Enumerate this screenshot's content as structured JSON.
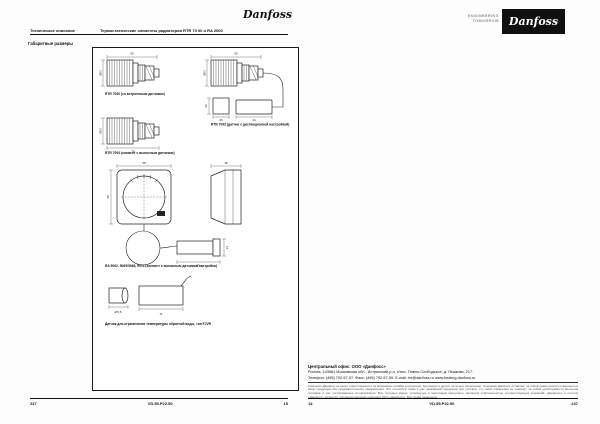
{
  "left_page": {
    "header": {
      "doc_type": "Техническое описание",
      "title": "Термостатические элементы радиаторов RTR 70 00 и RA 2000"
    },
    "logo_text": "Danfoss",
    "section_label": "Габаритные размеры",
    "figures": {
      "fig1_caption": "RTR 7090 (со встроенным датчиком)",
      "fig2_caption": "RTR 7092 (датчик с дистанционной настройкой)",
      "fig3_caption": "RTR 7094 (элемент с выносным датчиком)",
      "fig4_caption": "RA 5062, 5065/5068, 5074 (элемент с выносным датчиком настройки)",
      "fig5_caption": "Датчик для ограничения температуры обратной воды, тип FJVR",
      "dims": {
        "d80": "80",
        "d53": "Ø53",
        "d74": "74",
        "d28": "28",
        "d26": "26",
        "d44": "44",
        "d58": "58",
        "d48": "48",
        "d63": "63",
        "d21": "21",
        "d71": "71",
        "d55": "Ø 5,5"
      }
    },
    "footer": {
      "page_left": "247",
      "doc_code": "VD.55.P22.50",
      "page_right": "15"
    }
  },
  "right_page": {
    "brand": {
      "tagline_line1": "ENGINEERING",
      "tagline_line2": "TOMORROW",
      "logo_text": "Danfoss"
    },
    "office": {
      "line1": "Центральный офис: ООО «Данфосс»",
      "line2": "Россия, 143581 Московская обл., Истринский р-н, с/пос. Павло-Слободское, д. Лешково, 217.",
      "line3": "Телефон: (495) 792-57-57.  Факс: (495) 792-57-59.  E-mail: he@danfoss.ru   www.heating.danfoss.ru"
    },
    "disclaimer": "Компания Данфосс не несёт ответственности за возможные ошибки в каталогах, брошюрах и других печатных материалах. Компания Данфосс оставляет за собой право вносить изменения в свою продукцию без предварительного уведомления. Это относится также к уже заказанной продукции при условии, что такие изменения не повлекут за собой необходимости внесения поправок в уже согласованные спецификации. Все торговые марки, упомянутые в настоящем материале, являются собственностью соответствующих компаний. «Данфосс» и логотип «Данфосс» являются торговыми марками компании ООО «Данфосс». Все права защищены.",
    "footer": {
      "page_left": "14",
      "doc_code": "VD.55.P22.50",
      "page_right": "247"
    }
  }
}
